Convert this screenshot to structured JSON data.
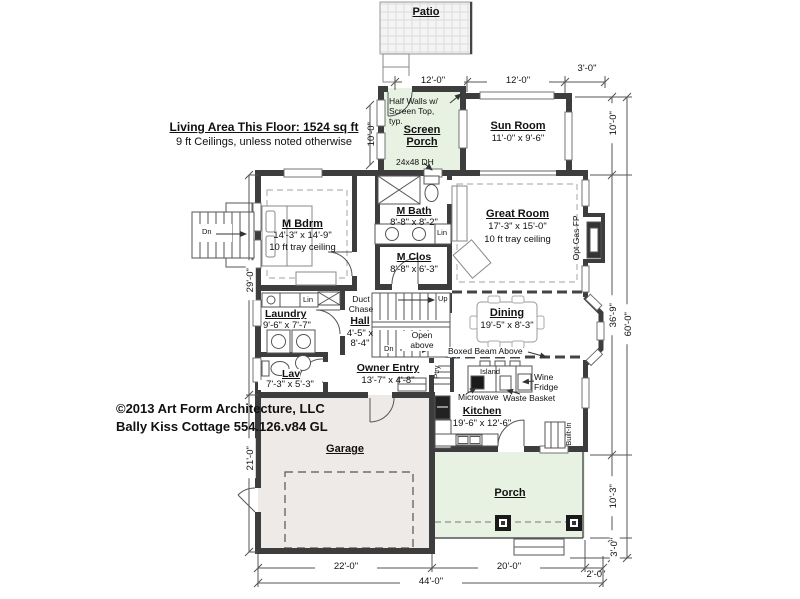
{
  "colors": {
    "wall": "#3d3d3d",
    "porch_fill": "#e7f2e3",
    "garage_fill": "#edeae7",
    "open_above_line": "#6fa3d8"
  },
  "patio": {
    "label": "Patio"
  },
  "header_notes": {
    "living_area": "Living Area This Floor: 1524 sq ft",
    "ceilings": "9 ft Ceilings, unless noted otherwise"
  },
  "copyright": {
    "line1": "©2013 Art Form Architecture, LLC",
    "line2": "Bally Kiss Cottage 554.126.v84 GL"
  },
  "rooms": {
    "screen_porch": {
      "name": "Screen Porch",
      "note": "Half Walls w/ Screen Top, typ.",
      "window": "24x48 DH",
      "height_dim": "10'-0\""
    },
    "sun_room": {
      "name": "Sun Room",
      "size": "11'-0\" x 9'-6\""
    },
    "m_bdrm": {
      "name": "M Bdrm",
      "size": "14'-3\" x 14'-9\"",
      "ceiling": "10 ft tray ceiling"
    },
    "m_bath": {
      "name": "M Bath",
      "size": "8'-8\" x 8'-2\"",
      "linen": "Lin"
    },
    "m_clos": {
      "name": "M Clos",
      "size": "8'-8\" x 6'-3\""
    },
    "great_room": {
      "name": "Great Room",
      "size": "17'-3\" x 15'-0\"",
      "ceiling": "10 ft tray ceiling",
      "fireplace": "Opt Gas FP"
    },
    "laundry": {
      "name": "Laundry",
      "size": "9'-6\" x 7'-7\"",
      "linen": "Lin"
    },
    "duct_chase": {
      "label": "Duct Chase"
    },
    "hall": {
      "name": "Hall",
      "size": "4'-5\" x 8'-4\""
    },
    "stairs": {
      "up": "Up",
      "down": "Dn",
      "open_above": "Open above"
    },
    "owner_entry": {
      "name": "Owner Entry",
      "size": "13'-7\" x 4'-8\""
    },
    "pantry": {
      "label": "Ptry"
    },
    "lav": {
      "name": "Lav",
      "size": "7'-3\" x 5'-3\""
    },
    "dining": {
      "name": "Dining",
      "size": "19'-5\" x 8'-3\"",
      "beam_note": "Boxed Beam Above"
    },
    "kitchen": {
      "name": "Kitchen",
      "size": "19'-6\" x 12'-6\"",
      "island": "Island",
      "wine_fridge": "Wine Fridge",
      "microwave": "Microwave",
      "waste_basket": "Waste Basket",
      "built_in": "Built-In"
    },
    "garage": {
      "name": "Garage"
    },
    "porch": {
      "name": "Porch"
    },
    "exterior_stair": {
      "down": "Dn"
    }
  },
  "dimensions": {
    "top": [
      "12'-0\"",
      "12'-0\"",
      "3'-0\""
    ],
    "right": {
      "segments": [
        "10'-0\"",
        "36'-9\"",
        "10'-3\"",
        "3'-0\""
      ],
      "overall": "60'-0\""
    },
    "left": [
      "29'-0\"",
      "21'-0\""
    ],
    "bottom": {
      "segments": [
        "22'-0\"",
        "20'-0\"",
        "2'-0\""
      ],
      "overall": "44'-0\""
    }
  }
}
